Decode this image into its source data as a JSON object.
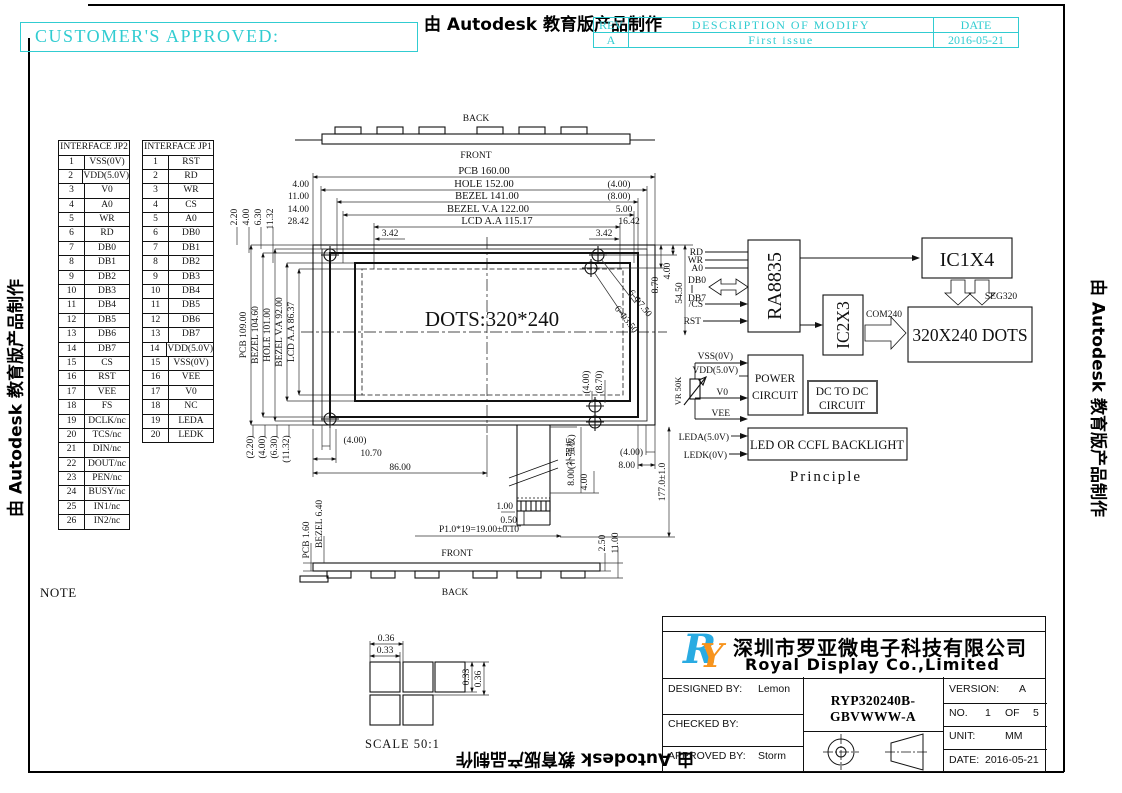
{
  "sheet": {
    "customer_approved": "CUSTOMER'S APPROVED:",
    "autodesk_credit": "由 Autodesk 教育版产品制作",
    "accent_color": "#31ccd1"
  },
  "revision_table": {
    "rev_header": "REV",
    "description_header": "DESCRIPTION OF MODIFY",
    "date_header": "DATE",
    "rows": [
      {
        "rev": "A",
        "description": "First issue",
        "date": "2016-05-21"
      }
    ]
  },
  "interface_jp2": {
    "title": "INTERFACE JP2",
    "pins": [
      {
        "n": "1",
        "name": "VSS(0V)"
      },
      {
        "n": "2",
        "name": "VDD(5.0V)"
      },
      {
        "n": "3",
        "name": "V0"
      },
      {
        "n": "4",
        "name": "A0"
      },
      {
        "n": "5",
        "name": "WR"
      },
      {
        "n": "6",
        "name": "RD"
      },
      {
        "n": "7",
        "name": "DB0"
      },
      {
        "n": "8",
        "name": "DB1"
      },
      {
        "n": "9",
        "name": "DB2"
      },
      {
        "n": "10",
        "name": "DB3"
      },
      {
        "n": "11",
        "name": "DB4"
      },
      {
        "n": "12",
        "name": "DB5"
      },
      {
        "n": "13",
        "name": "DB6"
      },
      {
        "n": "14",
        "name": "DB7"
      },
      {
        "n": "15",
        "name": "CS"
      },
      {
        "n": "16",
        "name": "RST"
      },
      {
        "n": "17",
        "name": "VEE"
      },
      {
        "n": "18",
        "name": "FS"
      },
      {
        "n": "19",
        "name": "DCLK/nc"
      },
      {
        "n": "20",
        "name": "TCS/nc"
      },
      {
        "n": "21",
        "name": "DIN/nc"
      },
      {
        "n": "22",
        "name": "DOUT/nc"
      },
      {
        "n": "23",
        "name": "PEN/nc"
      },
      {
        "n": "24",
        "name": "BUSY/nc"
      },
      {
        "n": "25",
        "name": "IN1/nc"
      },
      {
        "n": "26",
        "name": "IN2/nc"
      }
    ]
  },
  "interface_jp1": {
    "title": "INTERFACE JP1",
    "pins": [
      {
        "n": "1",
        "name": "RST"
      },
      {
        "n": "2",
        "name": "RD"
      },
      {
        "n": "3",
        "name": "WR"
      },
      {
        "n": "4",
        "name": "CS"
      },
      {
        "n": "5",
        "name": "A0"
      },
      {
        "n": "6",
        "name": "DB0"
      },
      {
        "n": "7",
        "name": "DB1"
      },
      {
        "n": "8",
        "name": "DB2"
      },
      {
        "n": "9",
        "name": "DB3"
      },
      {
        "n": "10",
        "name": "DB4"
      },
      {
        "n": "11",
        "name": "DB5"
      },
      {
        "n": "12",
        "name": "DB6"
      },
      {
        "n": "13",
        "name": "DB7"
      },
      {
        "n": "14",
        "name": "VDD(5.0V)"
      },
      {
        "n": "15",
        "name": "VSS(0V)"
      },
      {
        "n": "16",
        "name": "VEE"
      },
      {
        "n": "17",
        "name": "V0"
      },
      {
        "n": "18",
        "name": "NC"
      },
      {
        "n": "19",
        "name": "LEDA"
      },
      {
        "n": "20",
        "name": "LEDK"
      }
    ]
  },
  "mech": {
    "back_top": "BACK",
    "front_top": "FRONT",
    "w_pcb": "PCB 160.00",
    "w_hole": "HOLE 152.00",
    "w_bezel": "BEZEL 141.00",
    "w_bezel_va": "BEZEL V.A 122.00",
    "w_lcd_aa": "LCD A.A 115.17",
    "lo1": "4.00",
    "lo2": "11.00",
    "lo3": "14.00",
    "lo4": "28.42",
    "ro1": "(4.00)",
    "ro2": "(8.00)",
    "ro3": "5.00",
    "ro4": "16.42",
    "g342l": "3.42",
    "g342r": "3.42",
    "tl1": "2.20",
    "tl2": "4.00",
    "tl3": "6.30",
    "tl4": "11.32",
    "h_pcb": "PCB 109.00",
    "h_bezel": "BEZEL 104.60",
    "h_hole": "HOLE 101.00",
    "h_bezel_va": "BEZEL V.A 92.00",
    "h_lcd_aa": "LCD A.A 86.37",
    "bl1": "(2.20)",
    "bl2": "(4.00)",
    "bl3": "(6.30)",
    "bl4": "(11.32)",
    "dots": "DOTS:320*240",
    "holes1": "6-Φ7.50",
    "holes2": "6-Φ3.50",
    "r870": "8.70",
    "r400": "4.00",
    "r5450": "54.50",
    "rp870": "(8.70)",
    "rp400": "(4.00)",
    "br400": "(4.00)",
    "br800": "8.00",
    "total_h": "177.0±1.0",
    "stiff": "8.00(补强板)",
    "t400": "4.00",
    "b400": "(4.00)",
    "b1070": "10.70",
    "b8600": "86.00",
    "p100": "1.00",
    "p050": "0.50",
    "pitch": "P1.0*19=19.00±0.10",
    "front_bot": "FRONT",
    "back_bot": "BACK",
    "t_bezel": "BEZEL 6.40",
    "t_pcb": "PCB 1.60",
    "tail1100": "11.00",
    "tail250": "2.50"
  },
  "block_diagram": {
    "sig_rd": "RD",
    "sig_wr": "WR",
    "sig_a0": "A0",
    "sig_db0": "DB0",
    "sig_db7": "DB7",
    "sig_cs": "/CS",
    "sig_rst": "RST",
    "controller": "RA8835",
    "ic_seg": "IC1X4",
    "ic_com": "IC2X3",
    "com_bus": "COM240",
    "seg_bus": "SEG320",
    "panel": "320X240 DOTS",
    "vss": "VSS(0V)",
    "vdd": "VDD(5.0V)",
    "v0": "V0",
    "vee": "VEE",
    "vr": "VR 50K",
    "power1": "POWER",
    "power2": "CIRCUIT",
    "dcdc1": "DC TO DC",
    "dcdc2": "CIRCUIT",
    "leda": "LEDA(5.0V)",
    "ledk": "LEDK(0V)",
    "backlight": "LED OR CCFL BACKLIGHT",
    "caption": "Principle"
  },
  "scale_view": {
    "h036": "0.36",
    "h033": "0.33",
    "v033": "0.33",
    "v036": "0.36",
    "caption": "SCALE 50:1"
  },
  "note": {
    "title": "NOTE",
    "lines": [
      " 1.LCD Display Type:STN/Blue",
      " 2.Polarzier Mode:Transmissive,Negative",
      " 3.Drive Method:1/240Duty,1/17Bias,",
      " 4.Viewing Direction:6:00",
      " 5.Logic Supply Voltage:5.0V",
      " 6.LCD Driving Voltage:23.0V",
      " 7.Operating Temp: -20 TO 70℃",
      " 8.Storage Temp: -30 TO 80℃",
      " 9.Control IC:RA8835 or Equivalent(SMD)",
      "10.Backlight Type:White,5.0V,180mA",
      "11.Connector:FFC",
      "12.Ulteriorly Tolerance:±0.2MM",
      "13.Rohs"
    ]
  },
  "title_block": {
    "logo_r": "R",
    "logo_y": "Y",
    "logo_blue": "#29abe2",
    "logo_orange": "#f7941d",
    "company_cn": "深圳市罗亚微电子科技有限公司",
    "company_en": "Royal Display Co.,Limited",
    "designed_label": "DESIGNED BY:",
    "designed": "Lemon",
    "checked_label": "CHECKED BY:",
    "checked": "",
    "approved_label": "APPROVED BY:",
    "approved": "Storm",
    "model": "RYP320240B-GBVWWW-A",
    "version_label": "VERSION:",
    "version": "A",
    "no_label": "NO.",
    "no_value": "1",
    "of_label": "OF",
    "of_value": "5",
    "unit_label": "UNIT:",
    "unit": "MM",
    "date_label": "DATE:",
    "date": "2016-05-21"
  }
}
